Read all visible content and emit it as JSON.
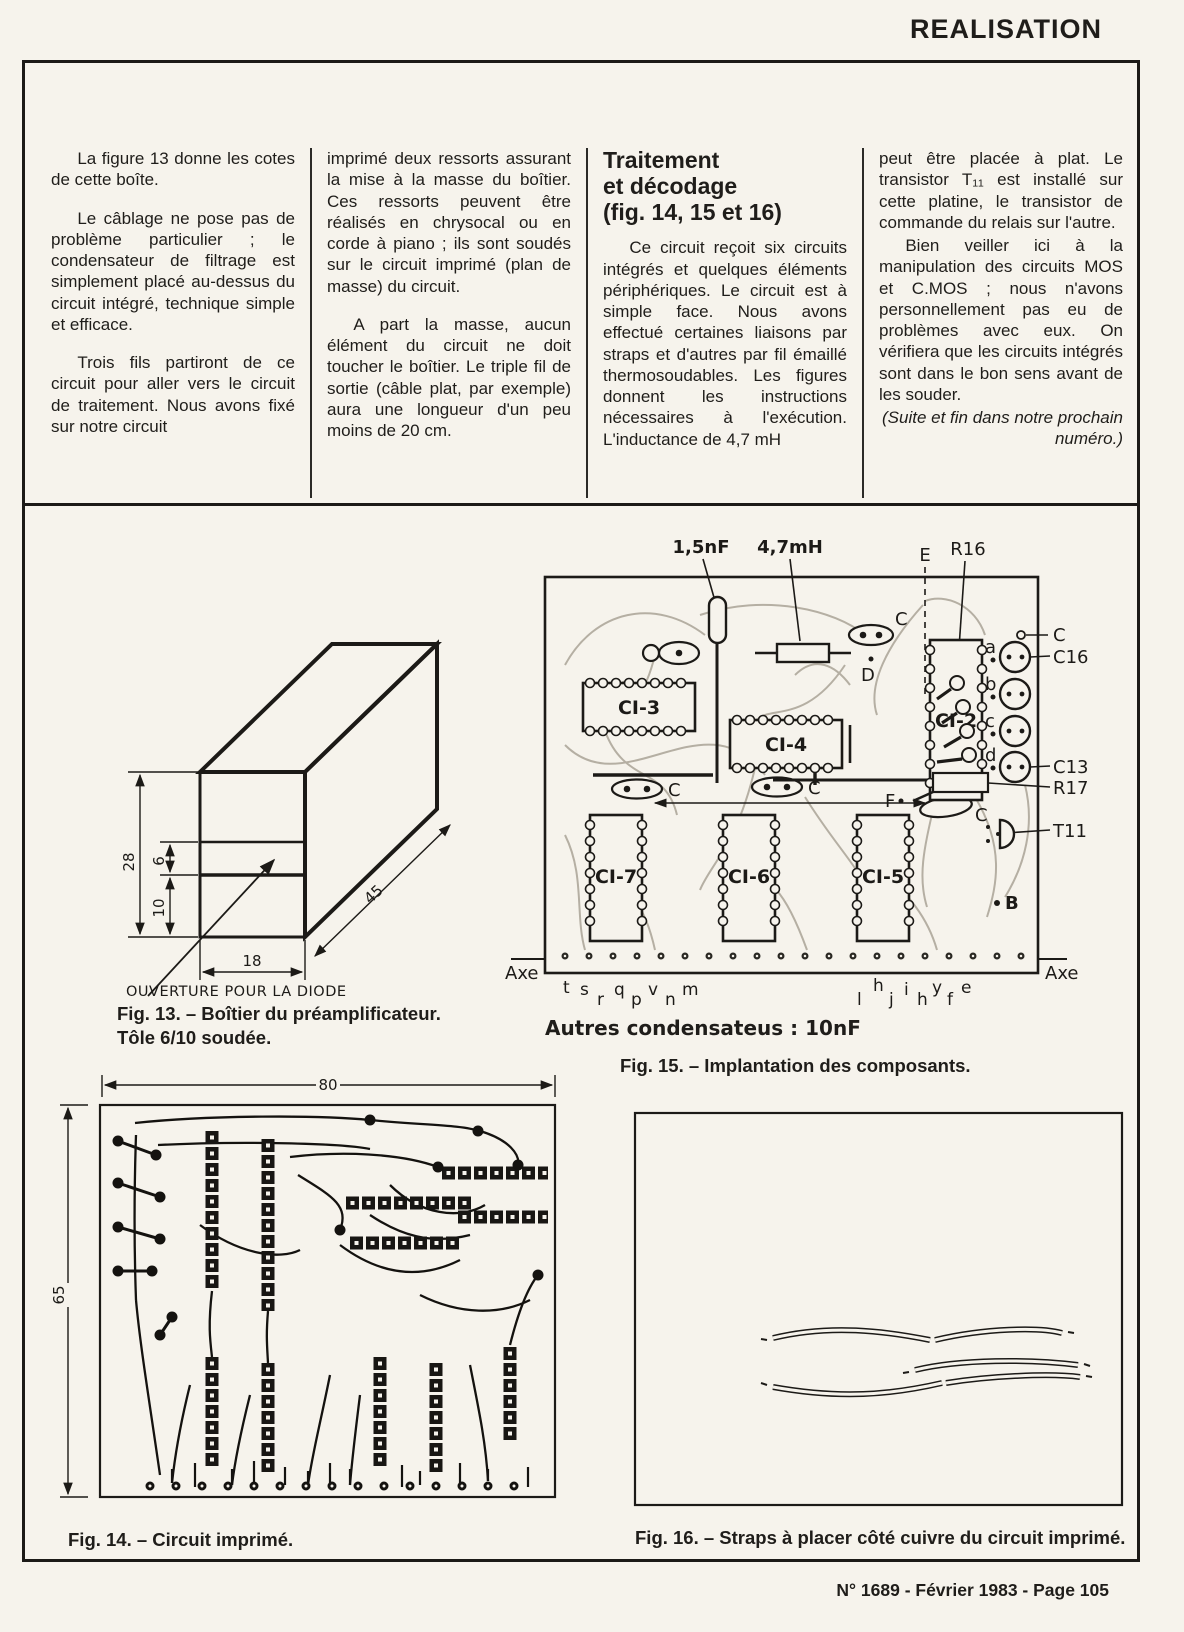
{
  "page": {
    "header": "REALISATION",
    "footer": "N° 1689 - Février 1983 - Page 105"
  },
  "columns": {
    "col1": [
      "La figure 13 donne les cotes de cette boîte.",
      "Le câblage ne pose pas de problème particulier ; le condensateur de filtrage est simplement placé au-dessus du circuit intégré, technique simple et efficace.",
      "Trois fils partiront de ce circuit pour aller vers le circuit de traitement. Nous avons fixé sur notre circuit"
    ],
    "col2": [
      "imprimé deux ressorts assurant la mise à la masse du boîtier. Ces ressorts peuvent être réalisés en chrysocal ou en corde à piano ; ils sont soudés sur le circuit imprimé (plan de masse) du circuit.",
      "A part la masse, aucun élément du circuit ne doit toucher le boîtier. Le triple fil de sortie (câble plat, par exemple) aura une longueur d'un peu moins de 20 cm."
    ],
    "col3_heading": "Traitement\net décodage\n(fig. 14, 15 et 16)",
    "col3": [
      "Ce circuit reçoit six circuits intégrés et quelques éléments périphériques. Le circuit est à simple face. Nous avons effectué certaines liaisons par straps et d'autres par fil émaillé thermosoudables. Les figures donnent les instructions nécessaires à l'exécution. L'inductance de 4,7 mH"
    ],
    "col4": [
      "peut être placée à plat. Le transistor T₁₁ est installé sur cette platine, le transistor de commande du relais sur l'autre.",
      "Bien veiller ici à la manipulation des circuits MOS et C.MOS ; nous n'avons personnellement pas eu de problèmes avec eux. On vérifiera que les circuits intégrés sont dans le bon sens avant de les souder."
    ],
    "col4_closing": "(Suite et fin dans notre prochain numéro.)"
  },
  "fig13": {
    "dim_height": "28",
    "dim_slot": "6",
    "dim_lower": "10",
    "dim_width": "18",
    "dim_depth": "45",
    "opening_label": "OUVERTURE POUR LA DIODE",
    "caption_line1": "Fig. 13. – Boîtier du préamplificateur.",
    "caption_line2": "Tôle 6/10 soudée."
  },
  "fig14": {
    "dim_width": "80",
    "dim_height": "65",
    "caption": "Fig. 14. – Circuit imprimé."
  },
  "fig15": {
    "cap_value": "1,5nF",
    "inductor_value": "4,7mH",
    "e": "E",
    "r16": "R16",
    "c_top": "C",
    "c16": "C16",
    "a": "a",
    "b": "b",
    "c": "c",
    "d": "d",
    "c13": "C13",
    "r17": "R17",
    "t11": "T11",
    "f": "F",
    "b_pad": "B",
    "d_pad": "D",
    "cap_c1": "C",
    "cap_c2": "C",
    "cap_c3": "C",
    "cap_c4": "C",
    "ci2": "CI-2",
    "ci3": "CI-3",
    "ci4": "CI-4",
    "ci5": "CI-5",
    "ci6": "CI-6",
    "ci7": "CI-7",
    "axe_left": "Axe",
    "axe_right": "Axe",
    "pins_left": [
      "t",
      "s",
      "r",
      "q",
      "p",
      "v",
      "n",
      "m"
    ],
    "pins_right": [
      "l",
      "h",
      "j",
      "i",
      "h",
      "y",
      "f",
      "e"
    ],
    "note": "Autres condensateus : 10nF",
    "caption": "Fig. 15. – Implantation des composants."
  },
  "fig16": {
    "caption": "Fig. 16. – Straps à placer côté cuivre du circuit imprimé."
  }
}
